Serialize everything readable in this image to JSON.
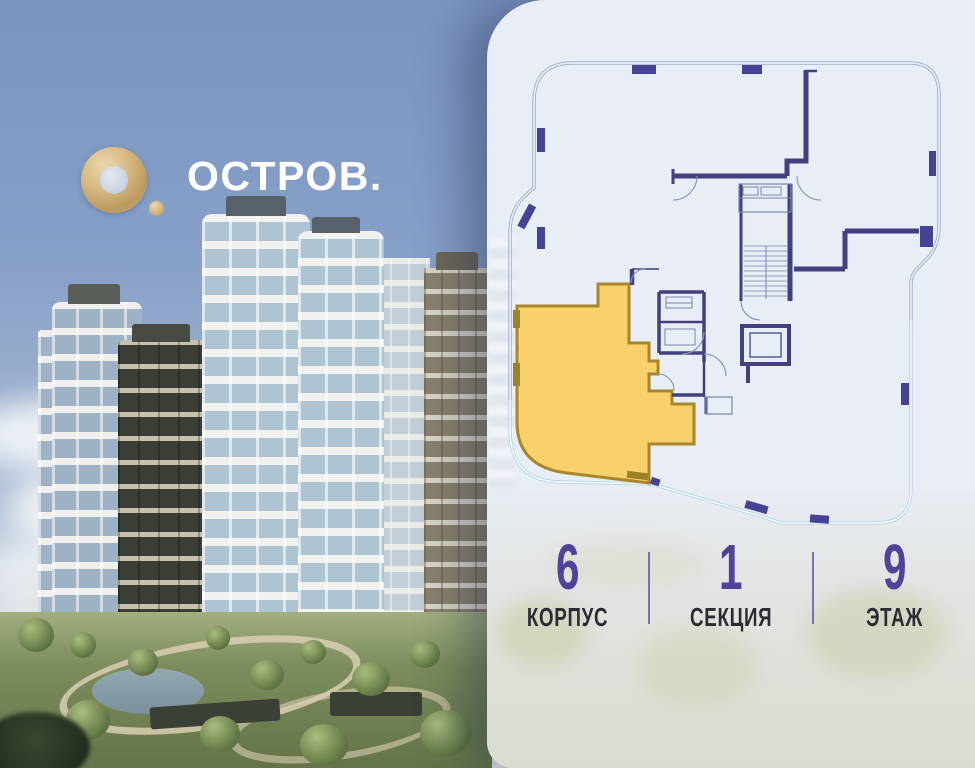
{
  "logo": {
    "brand": "ОСТРОВ.",
    "mark": "gold-ring-with-dot"
  },
  "floorplan": {
    "description": "building footprint floor plan with highlighted apartment",
    "highlighted_unit_color": "#F8D16B",
    "highlight_border_color": "#A8872A",
    "wall_color": "#44407E",
    "outline_color": "#9AA2C0",
    "outline_color_lower": "#AED2E2"
  },
  "stats": {
    "accent_color": "#50439A",
    "items": [
      {
        "value": "6",
        "label": "КОРПУС"
      },
      {
        "value": "1",
        "label": "СЕКЦИЯ"
      },
      {
        "value": "9",
        "label": "ЭТАЖ"
      }
    ]
  }
}
